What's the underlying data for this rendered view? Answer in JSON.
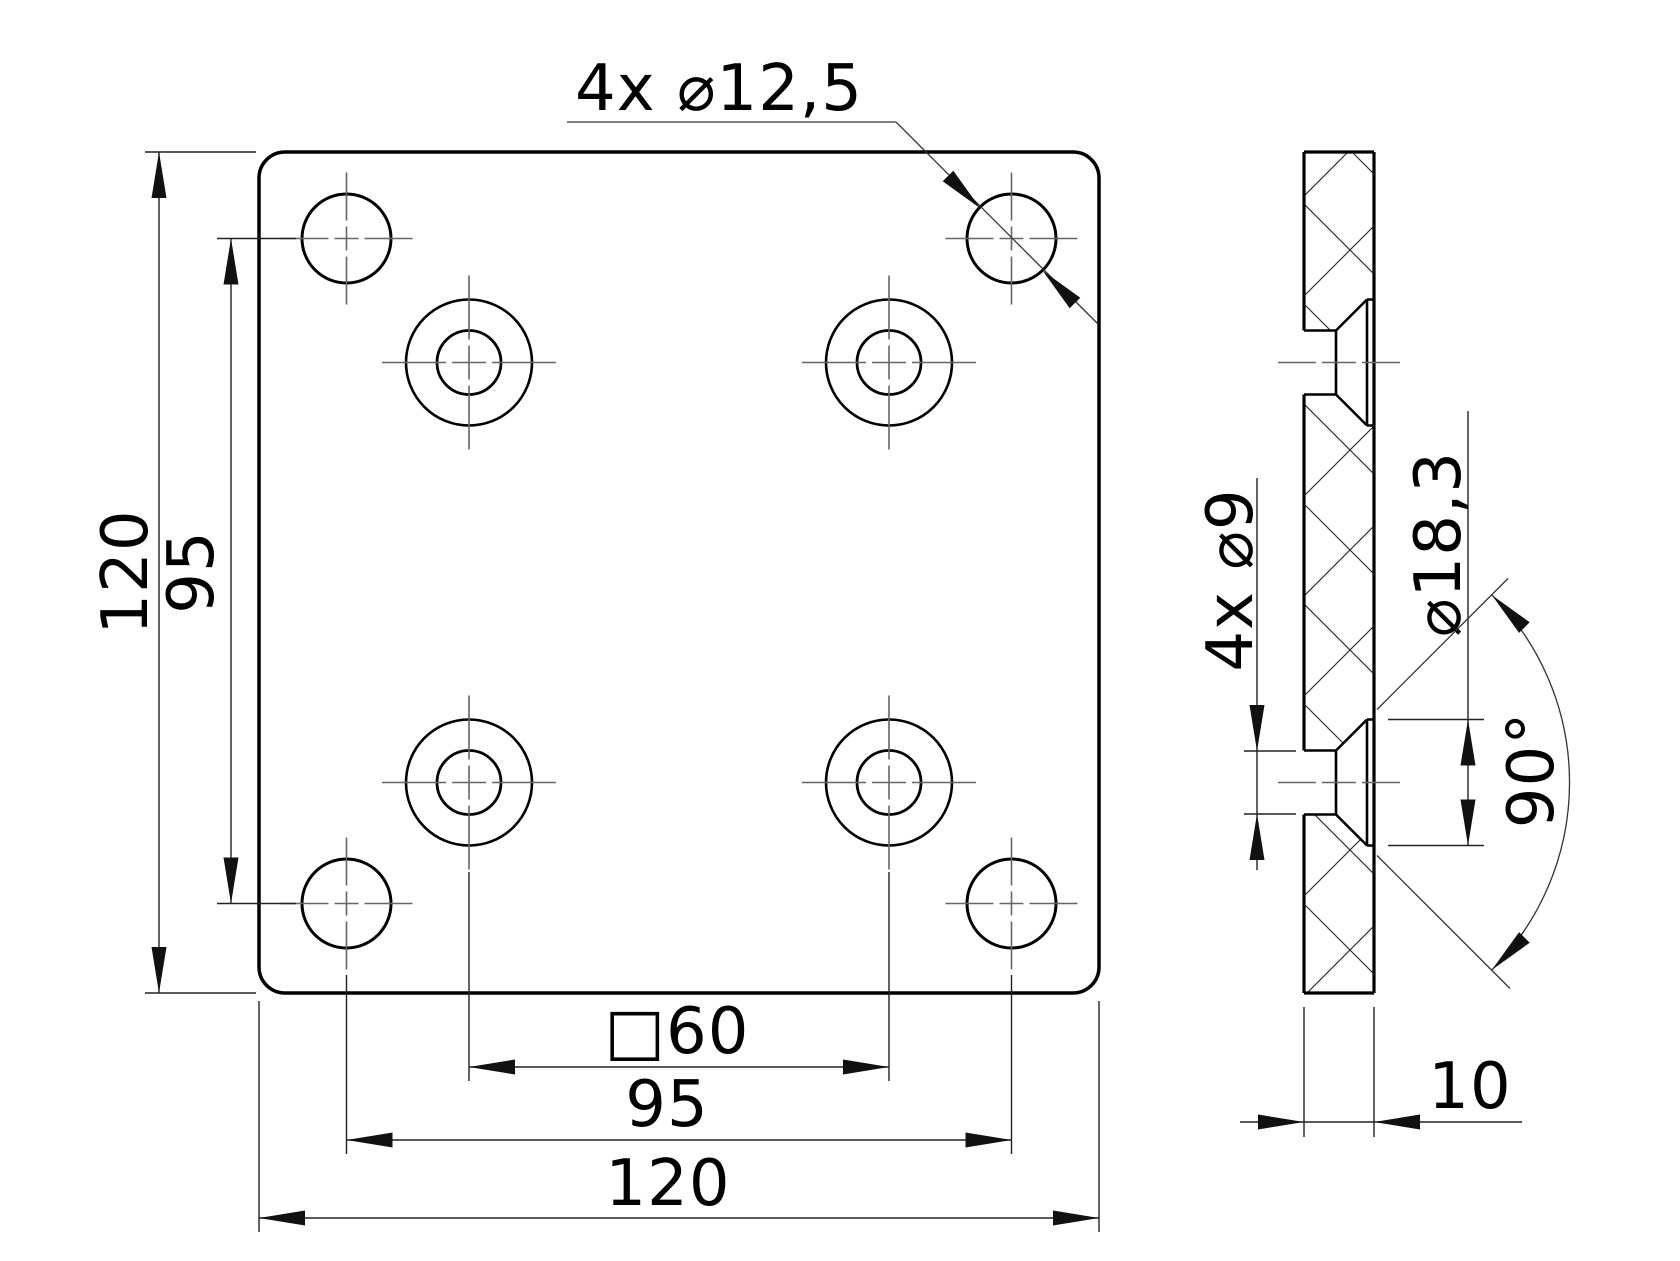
{
  "drawing": {
    "front_view": {
      "callout_corner_holes": "4x ⌀12,5",
      "dim_height": "120",
      "dim_hole_spacing_vertical": "95",
      "dim_square_spacing": "□60",
      "dim_hole_spacing_horizontal": "95",
      "dim_width": "120"
    },
    "side_view": {
      "callout_bore": "4x ⌀9",
      "dim_countersink_diameter": "⌀18,3",
      "dim_countersink_angle": "90°",
      "dim_thickness": "10"
    },
    "colors": {
      "background": "#ffffff",
      "geometry_line": "#000000",
      "dimension_line": "#222222",
      "centerline": "#666666"
    }
  }
}
